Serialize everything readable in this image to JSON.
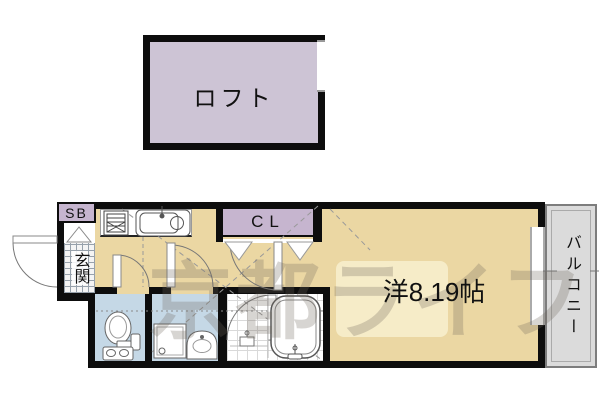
{
  "document": {
    "type": "apartment-floorplan"
  },
  "rooms": {
    "loft": {
      "label": "ロフト"
    },
    "shoe_box": {
      "label": "SB"
    },
    "entrance": {
      "label": "玄関"
    },
    "closet": {
      "label": "CL"
    },
    "main_room": {
      "label": "洋8.19帖",
      "area_tatami": "8.19"
    },
    "balcony": {
      "label": "バルコニー"
    }
  },
  "watermark": {
    "text": "京都ライフ"
  },
  "colors": {
    "wall": "#0d0d0d",
    "floor_tan": "#ebd7a3",
    "loft_purple": "#cdc4d5",
    "label_lavender": "#c6b5cf",
    "wet_blue": "#c5d8e6",
    "balcony_gray": "#dbdbdb",
    "highlight_cream": "#f6eecb",
    "line_gray": "#888888",
    "watermark_gray": "#6f665c"
  },
  "icons": {
    "stove": "two-burner grid square",
    "sink": "rounded basin with faucet",
    "toilet": "toilet with tank",
    "washing_machine": "square pan with drain",
    "washbasin": "arched vanity with bowl",
    "bathtub": "rounded tub with tap",
    "door": "quarter-arc swing",
    "closet_door": "folding V panels"
  }
}
